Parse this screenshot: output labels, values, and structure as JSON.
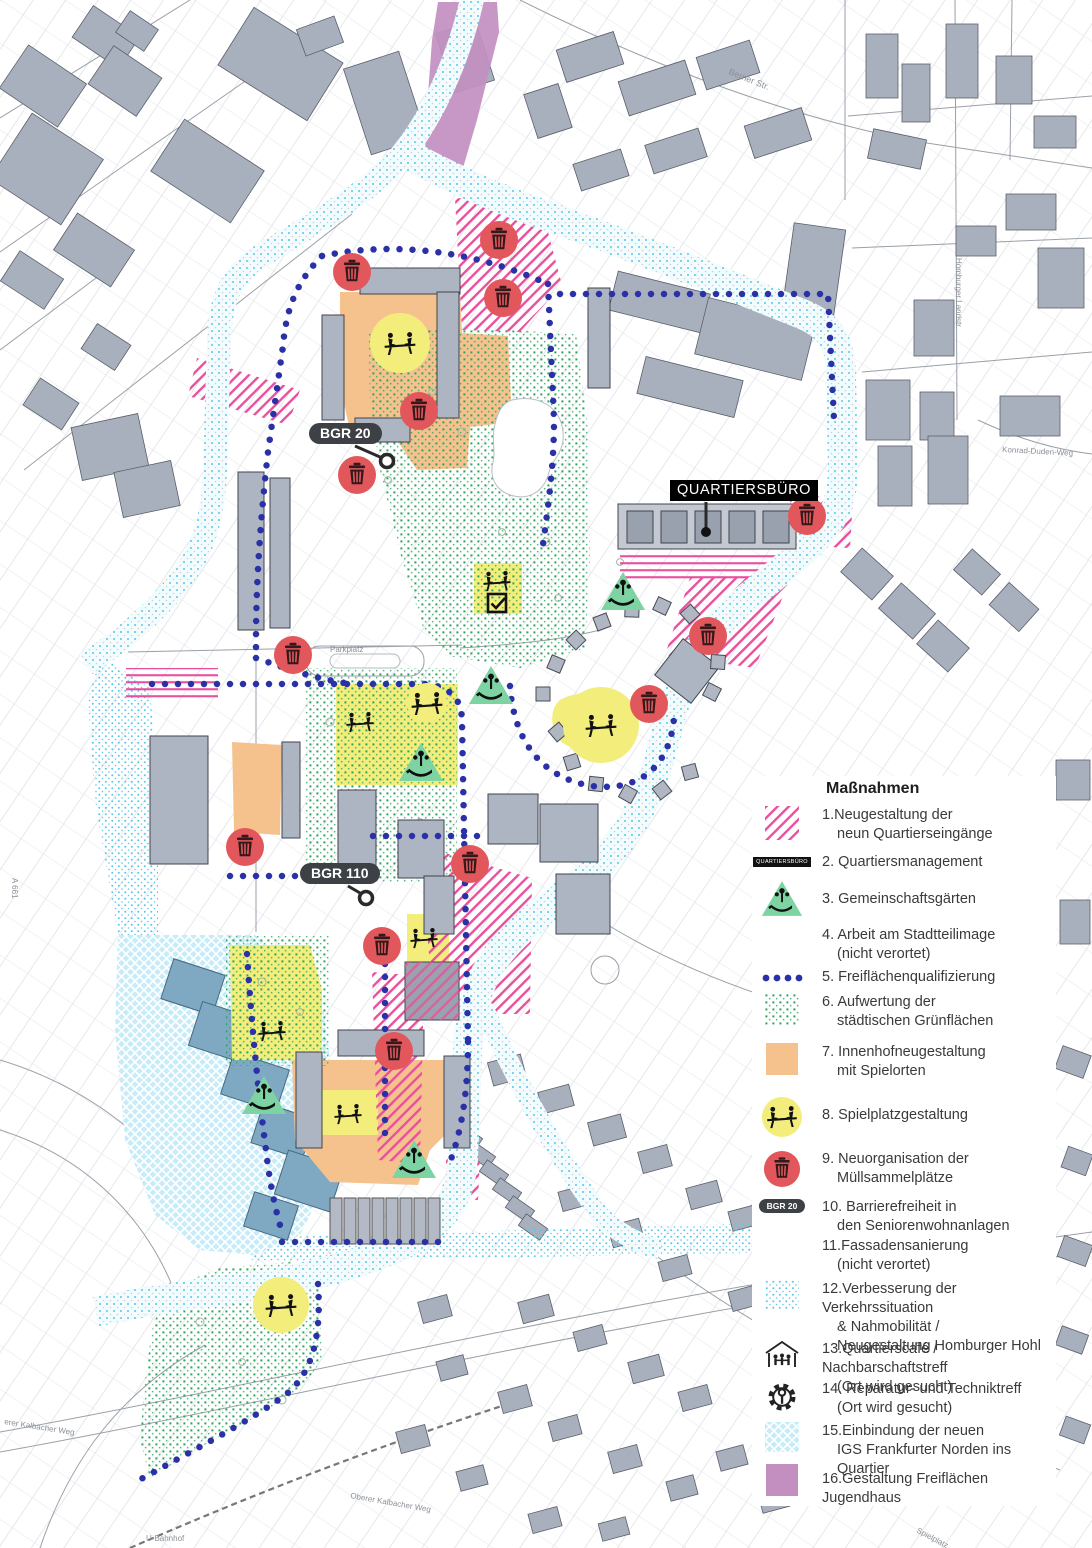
{
  "legend": {
    "title": "Maßnahmen",
    "items": [
      {
        "swatch": "pink-hatch",
        "lines": [
          "1.Neugestaltung der",
          "neun Quartierseingänge"
        ]
      },
      {
        "swatch": "qb-label",
        "swatch_text": "QUARTIERSBÜRO",
        "lines": [
          "2. Quartiersmanagement"
        ]
      },
      {
        "swatch": "garden",
        "lines": [
          "3. Gemeinschaftsgärten"
        ]
      },
      {
        "swatch": "none",
        "lines": [
          "4. Arbeit am Stadtteilimage",
          "(nicht verortet)"
        ]
      },
      {
        "swatch": "blue-dots",
        "lines": [
          "5. Freiflächenqualifizierung"
        ]
      },
      {
        "swatch": "green-dots",
        "lines": [
          "6. Aufwertung der",
          "städtischen Grünflächen"
        ]
      },
      {
        "swatch": "orange-square",
        "lines": [
          "7. Innenhofneugestaltung",
          "mit Spielorten"
        ]
      },
      {
        "swatch": "play-circle",
        "lines": [
          "8. Spielplatzgestaltung"
        ]
      },
      {
        "swatch": "trash-circle",
        "lines": [
          "9. Neuorganisation der",
          "Müllsammelplätze"
        ]
      },
      {
        "swatch": "bgr-pill",
        "swatch_text": "BGR 20",
        "lines": [
          "10. Barrierefreiheit in",
          "den Seniorenwohnanlagen"
        ]
      },
      {
        "swatch": "none",
        "lines": [
          "11.Fassadensanierung",
          "(nicht verortet)"
        ]
      },
      {
        "swatch": "cyan-dots",
        "lines": [
          "12.Verbesserung der Verkehrssituation",
          "& Nahmobilität /",
          "Neugestaltung Homburger Hohl"
        ]
      },
      {
        "swatch": "house",
        "lines": [
          "13.Quartierscafé / Nachbarschaftstreff",
          "(Ort wird gesucht)"
        ]
      },
      {
        "swatch": "gear",
        "lines": [
          "14. Reparatur- und Techniktreff",
          "(Ort wird gesucht)"
        ]
      },
      {
        "swatch": "cyan-cross",
        "lines": [
          "15.Einbindung der neuen",
          "IGS Frankfurter Norden ins Quartier"
        ]
      },
      {
        "swatch": "purple-square",
        "lines": [
          "16.Gestaltung Freiflächen Jugendhaus"
        ]
      }
    ]
  },
  "map": {
    "callouts": [
      {
        "id": "quartiersbuero",
        "style": "box",
        "text": "QUARTIERSBÜRO",
        "x": 670,
        "y": 480,
        "leader": [
          [
            706,
            502
          ],
          [
            706,
            528
          ]
        ],
        "dot": [
          706,
          532
        ]
      },
      {
        "id": "bgr20",
        "style": "pill",
        "text": "BGR 20",
        "x": 309,
        "y": 423,
        "leader": [
          [
            355,
            446
          ],
          [
            380,
            457
          ]
        ],
        "ring": [
          387,
          461
        ]
      },
      {
        "id": "bgr110",
        "style": "pill",
        "text": "BGR 110",
        "x": 300,
        "y": 863,
        "leader": [
          [
            348,
            886
          ],
          [
            360,
            893
          ]
        ],
        "ring": [
          366,
          898
        ]
      }
    ],
    "street_labels": [
      {
        "text": "Berner Str.",
        "x": 728,
        "y": 74,
        "rot": 22,
        "size": 9
      },
      {
        "text": "Homburger Landstr.",
        "x": 956,
        "y": 258,
        "rot": 90,
        "size": 8
      },
      {
        "text": "Konrad-Duden-Weg",
        "x": 1002,
        "y": 452,
        "rot": 3,
        "size": 8
      },
      {
        "text": "Parkplatz",
        "x": 330,
        "y": 652,
        "rot": 0,
        "size": 8
      },
      {
        "text": "Spielplatz",
        "x": 916,
        "y": 1532,
        "rot": 28,
        "size": 8
      },
      {
        "text": "erer Kalbacher Weg",
        "x": 4,
        "y": 1424,
        "rot": 9,
        "size": 8
      },
      {
        "text": "Oberer Kalbacher Weg",
        "x": 350,
        "y": 1498,
        "rot": 10,
        "size": 8
      },
      {
        "text": "U-Bahnhof",
        "x": 146,
        "y": 1541,
        "rot": 0,
        "size": 8
      },
      {
        "text": "A 661",
        "x": 12,
        "y": 878,
        "rot": 90,
        "size": 8
      }
    ],
    "markers": {
      "trash": [
        [
          352,
          272
        ],
        [
          499,
          240
        ],
        [
          503,
          298
        ],
        [
          419,
          411
        ],
        [
          357,
          475
        ],
        [
          293,
          655
        ],
        [
          807,
          516
        ],
        [
          708,
          636
        ],
        [
          649,
          704
        ],
        [
          245,
          847
        ],
        [
          470,
          864
        ],
        [
          382,
          946
        ],
        [
          394,
          1051
        ]
      ],
      "play_circles": [
        [
          400,
          343,
          30
        ],
        [
          427,
          703,
          20
        ],
        [
          601,
          725,
          38
        ],
        [
          281,
          1305,
          28
        ]
      ],
      "garden_triangles": [
        [
          623,
          590
        ],
        [
          491,
          684
        ],
        [
          421,
          761
        ],
        [
          264,
          1094
        ],
        [
          414,
          1158
        ]
      ],
      "play_icons": [
        [
          360,
          722
        ],
        [
          424,
          938
        ],
        [
          272,
          1031
        ],
        [
          348,
          1114
        ],
        [
          497,
          581
        ]
      ],
      "check_icons": [
        [
          497,
          603
        ]
      ]
    }
  },
  "colors": {
    "pink": "#ea4f9e",
    "blue_dot": "#2a30a6",
    "green_dot": "#2ba55e",
    "cyan": "#57c8e8",
    "orange": "#f5c28e",
    "yellow": "#f3ee7b",
    "red": "#e2575b",
    "triangle_green": "#7ed3a2",
    "purple": "#c28fc0",
    "igs_fill": "#c6ecf8",
    "building_gray": "#a9b0bd",
    "callout_dark": "#3d4145"
  }
}
